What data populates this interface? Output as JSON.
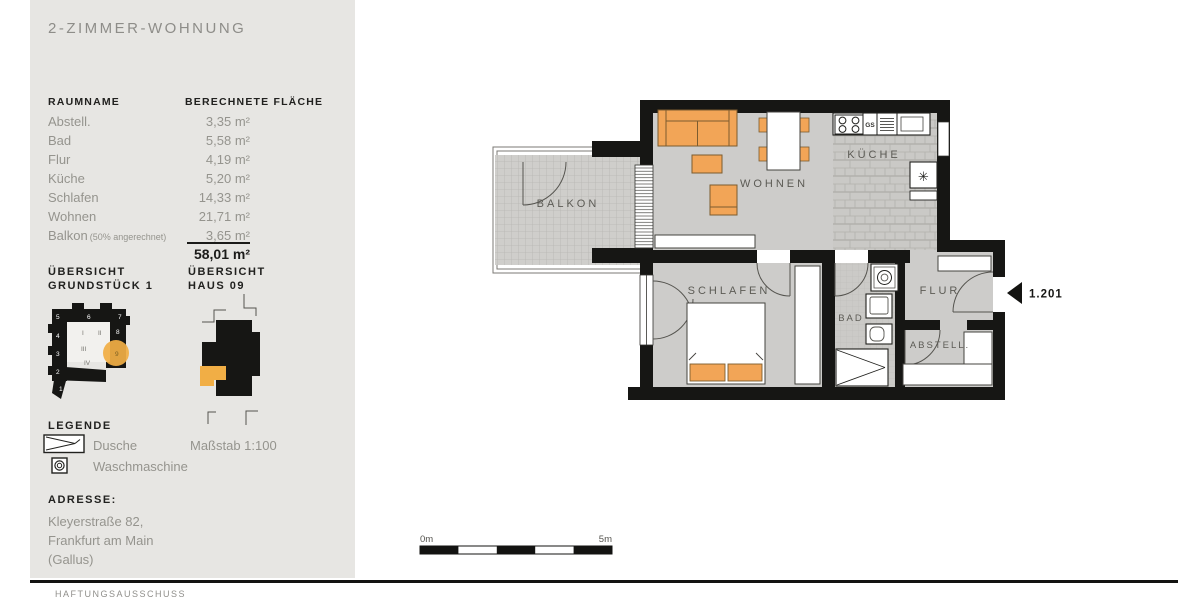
{
  "colors": {
    "accent_orange": "#F2A557",
    "highlight_orange": "#F1AE45",
    "wall_black": "#161614",
    "floor_gray": "#CDCCCA",
    "panel_gray": "#E7E6E3"
  },
  "header": {
    "title": "WOHNUNG 1.201",
    "subtitle": "2-ZIMMER-WOHNUNG"
  },
  "room_table": {
    "col_name": "RAUMNAME",
    "col_area": "BERECHNETE FLÄCHE",
    "rows": [
      {
        "name": "Abstell.",
        "area": "3,35 m²"
      },
      {
        "name": "Bad",
        "area": "5,58 m²"
      },
      {
        "name": "Flur",
        "area": "4,19 m²"
      },
      {
        "name": "Küche",
        "area": "5,20 m²"
      },
      {
        "name": "Schlafen",
        "area": "14,33 m²"
      },
      {
        "name": "Wohnen",
        "area": "21,71 m²"
      },
      {
        "name": "Balkon",
        "note": "(50% angerechnet)",
        "area": "3,65 m²"
      }
    ],
    "total": "58,01 m²"
  },
  "overviews": {
    "site_line1": "ÜBERSICHT",
    "site_line2": "GRUNDSTÜCK 1",
    "house_line1": "ÜBERSICHT",
    "house_line2": "HAUS 09",
    "site_numbers": [
      "1",
      "2",
      "3",
      "4",
      "5",
      "6",
      "7",
      "8",
      "9"
    ],
    "site_sections": [
      "I",
      "II",
      "III",
      "IV"
    ]
  },
  "legend": {
    "heading": "LEGENDE",
    "shower_label": "Dusche",
    "washer_label": "Waschmaschine",
    "scale_note": "Maßstab 1:100"
  },
  "address": {
    "heading": "ADRESSE:",
    "line1": "Kleyerstraße 82,",
    "line2": "Frankfurt am Main",
    "line3": "(Gallus)"
  },
  "floorplan": {
    "rooms": {
      "balkon": "BALKON",
      "wohnen": "WOHNEN",
      "kueche": "KÜCHE",
      "schlafen": "SCHLAFEN",
      "bad": "BAD",
      "flur": "FLUR",
      "abstell": "ABSTELL."
    },
    "unit_label": "1.201",
    "dishwasher_label": "GS",
    "fridge_symbol": "✳"
  },
  "scalebar": {
    "start": "0m",
    "end": "5m"
  },
  "compass": {
    "label": "N"
  },
  "footer": {
    "disclaimer": "HAFTUNGSAUSSCHUSS"
  }
}
